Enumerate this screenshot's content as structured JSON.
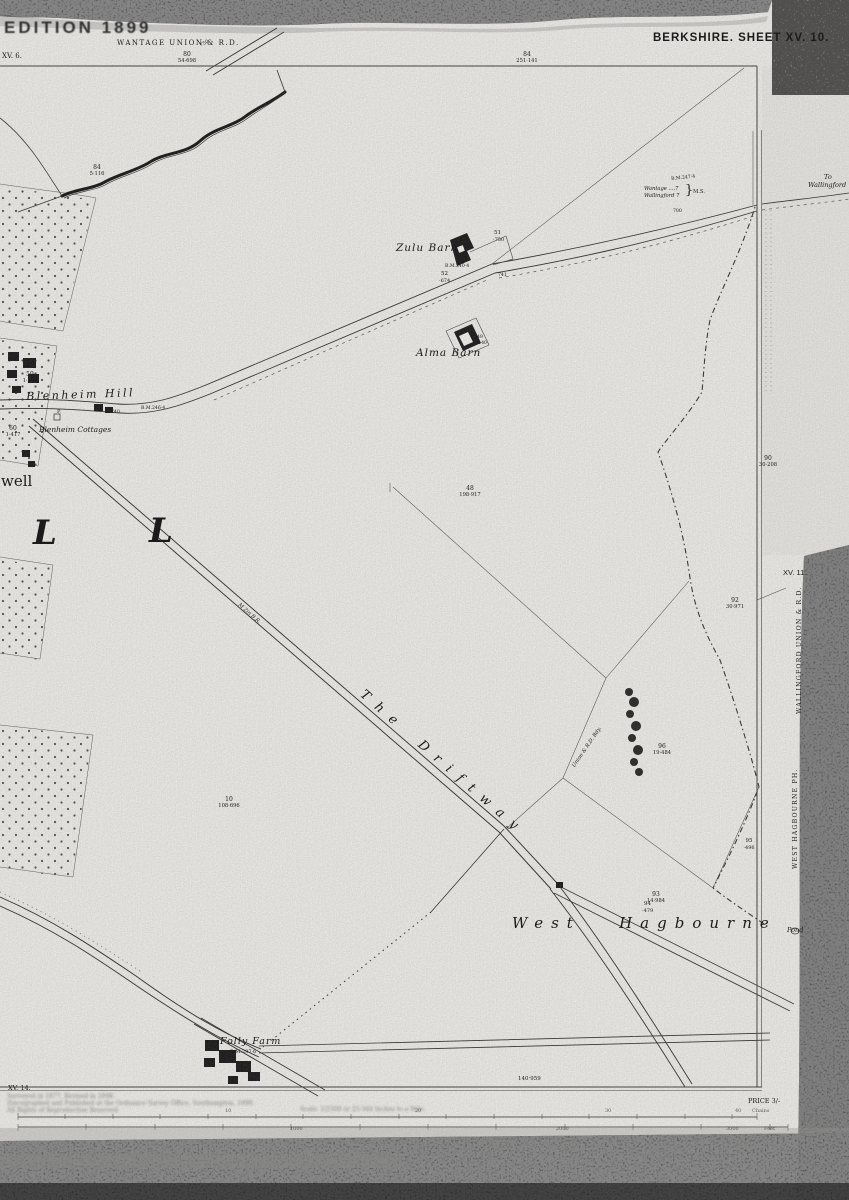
{
  "colors": {
    "paper": "#f2f1ed",
    "ink": "#1b1b1b",
    "scan_band": "#0d0d0d",
    "faint_line": "#4a4a4a"
  },
  "sheet": {
    "edition": "EDITION 1899",
    "title": "BERKSHIRE. SHEET XV. 10."
  },
  "labels": [
    {
      "n": "edition-label",
      "t": "EDITION 1899",
      "x": 4,
      "y": 19,
      "s": 17,
      "ls": 3,
      "c": "sans b deg"
    },
    {
      "n": "wantage-union-label",
      "t": "WANTAGE UNION & R.D.",
      "x": 117,
      "y": 40,
      "s": 7,
      "ls": 1.5
    },
    {
      "n": "adjacent-sheet-xv6",
      "t": "XV. 6.",
      "x": 2,
      "y": 53,
      "s": 7
    },
    {
      "n": "sheet-title",
      "t": "BERKSHIRE. SHEET XV. 10.",
      "x": 653,
      "y": 33,
      "s": 11.5,
      "ls": 1,
      "c": "sans b"
    },
    {
      "n": "parcel-80-number",
      "t": "80",
      "x": 187,
      "y": 52,
      "s": 6,
      "c": "ctr"
    },
    {
      "n": "parcel-80-area",
      "t": "54·698",
      "x": 187,
      "y": 59,
      "s": 5.2,
      "c": "ctr"
    },
    {
      "n": "parcel-84-number",
      "t": "84",
      "x": 527,
      "y": 52,
      "s": 6,
      "c": "ctr"
    },
    {
      "n": "parcel-84-area",
      "t": "251·141",
      "x": 527,
      "y": 59,
      "s": 5.2,
      "c": "ctr"
    },
    {
      "n": "spot-height-750",
      "t": "750",
      "x": 200,
      "y": 45,
      "s": 4.8,
      "r": -30
    },
    {
      "n": "parcel-84w-number",
      "t": "84",
      "x": 97,
      "y": 165,
      "s": 6,
      "c": "ctr"
    },
    {
      "n": "parcel-84w-area",
      "t": "5·116",
      "x": 97,
      "y": 172,
      "s": 5.2,
      "c": "ctr"
    },
    {
      "n": "parcel-59-number",
      "t": "59",
      "x": 30,
      "y": 372,
      "s": 6,
      "c": "ctr"
    },
    {
      "n": "parcel-59-area",
      "t": "1·204",
      "x": 30,
      "y": 379,
      "s": 5.2,
      "c": "ctr"
    },
    {
      "n": "parcel-60-number",
      "t": "60",
      "x": 13,
      "y": 426,
      "s": 6,
      "c": "ctr"
    },
    {
      "n": "parcel-60-area",
      "t": "1·417",
      "x": 13,
      "y": 433,
      "s": 5.2,
      "c": "ctr"
    },
    {
      "n": "zulu-barn-label",
      "t": "Zulu Barn",
      "x": 396,
      "y": 243,
      "s": 10.5,
      "ls": 1,
      "c": "it"
    },
    {
      "n": "parcel-51-number",
      "t": "51",
      "x": 494,
      "y": 231,
      "s": 5.5
    },
    {
      "n": "parcel-51-area",
      "t": "·750",
      "x": 493,
      "y": 238,
      "s": 5
    },
    {
      "n": "bm-240-4",
      "t": "B.M.240·4",
      "x": 445,
      "y": 265,
      "s": 4.6
    },
    {
      "n": "parcel-52-number",
      "t": "52",
      "x": 441,
      "y": 272,
      "s": 5.5
    },
    {
      "n": "parcel-52-area",
      "t": "·674",
      "x": 439,
      "y": 279,
      "s": 5
    },
    {
      "n": "level-741",
      "t": "741",
      "x": 498,
      "y": 274,
      "s": 4.6
    },
    {
      "n": "alma-barn-label",
      "t": "Alma Barn",
      "x": 416,
      "y": 348,
      "s": 10.5,
      "ls": 1,
      "c": "it"
    },
    {
      "n": "parcel-49-number",
      "t": "49",
      "x": 477,
      "y": 336,
      "s": 4.6
    },
    {
      "n": "parcel-49-area",
      "t": "·140",
      "x": 477,
      "y": 342,
      "s": 4.4
    },
    {
      "n": "blenheim-hill-label",
      "t": "Blenheim Hill",
      "x": 26,
      "y": 391,
      "s": 11,
      "ls": 2.5,
      "r": -2,
      "c": "it"
    },
    {
      "n": "level-740",
      "t": "740",
      "x": 111,
      "y": 411,
      "s": 4.6
    },
    {
      "n": "bm-246-4",
      "t": "B.M.246·4",
      "x": 141,
      "y": 407,
      "s": 4.6
    },
    {
      "n": "pump-label",
      "t": "P.",
      "x": 57,
      "y": 410,
      "s": 5
    },
    {
      "n": "blenheim-cottages-label",
      "t": "Blenheim Cottages",
      "x": 39,
      "y": 426,
      "s": 7.5,
      "c": "it"
    },
    {
      "n": "well-name-fragment",
      "t": "well",
      "x": 1,
      "y": 474,
      "s": 15
    },
    {
      "n": "district-letter-l1",
      "t": "L",
      "x": 33,
      "y": 516,
      "s": 34,
      "c": "it b"
    },
    {
      "n": "district-letter-l2",
      "t": "L",
      "x": 149,
      "y": 514,
      "s": 34,
      "c": "it b"
    },
    {
      "n": "parcel-48-number",
      "t": "48",
      "x": 470,
      "y": 486,
      "s": 6,
      "c": "ctr"
    },
    {
      "n": "parcel-48-area",
      "t": "198·917",
      "x": 470,
      "y": 493,
      "s": 5.2,
      "c": "ctr"
    },
    {
      "n": "ms-destination-1",
      "t": "Wantage ....7",
      "x": 644,
      "y": 187,
      "s": 5.2,
      "c": "it"
    },
    {
      "n": "ms-destination-2",
      "t": "Wallingford 7",
      "x": 644,
      "y": 194,
      "s": 5.2,
      "c": "it"
    },
    {
      "n": "ms-brace",
      "t": "}",
      "x": 685,
      "y": 184,
      "s": 13
    },
    {
      "n": "milestone-label",
      "t": "M.S.",
      "x": 693,
      "y": 190,
      "s": 5.2
    },
    {
      "n": "bm-247-4",
      "t": "B.M.247·4",
      "x": 671,
      "y": 178,
      "s": 4.6,
      "r": -6
    },
    {
      "n": "to-wallingford-line1",
      "t": "To",
      "x": 824,
      "y": 174,
      "s": 6.5,
      "c": "it"
    },
    {
      "n": "to-wallingford-line2",
      "t": "Wallingford",
      "x": 808,
      "y": 182,
      "s": 6.5,
      "c": "it"
    },
    {
      "n": "level-700",
      "t": "700",
      "x": 673,
      "y": 210,
      "s": 4.6
    },
    {
      "n": "parcel-90-number",
      "t": "90",
      "x": 768,
      "y": 456,
      "s": 6,
      "c": "ctr"
    },
    {
      "n": "parcel-90-area",
      "t": "30·208",
      "x": 768,
      "y": 463,
      "s": 5.2,
      "c": "ctr"
    },
    {
      "n": "adjacent-sheet-xv11",
      "t": "XV. 11.",
      "x": 783,
      "y": 569,
      "s": 7.5,
      "c": "sans"
    },
    {
      "n": "wallingford-union-vertical",
      "t": "WALLINGFORD UNION & R.D.",
      "x": 797,
      "y": 714,
      "s": 6.2,
      "ls": 1.2,
      "r": -90
    },
    {
      "n": "parcel-92-number",
      "t": "92",
      "x": 735,
      "y": 598,
      "s": 6,
      "c": "ctr"
    },
    {
      "n": "parcel-92-area",
      "t": "30·971",
      "x": 735,
      "y": 605,
      "s": 5.2,
      "c": "ctr"
    },
    {
      "n": "bridle-road-annotation",
      "t": "M 2in B.R.",
      "x": 240,
      "y": 603,
      "s": 5.2,
      "r": 41,
      "c": "it"
    },
    {
      "n": "driftway-label",
      "t": "T h e    D r i f t w a y",
      "x": 366,
      "y": 688,
      "s": 13,
      "ls": 3,
      "r": 41,
      "c": "it"
    },
    {
      "n": "boundary-annotation",
      "t": "Union & R.D. Bdy.",
      "x": 572,
      "y": 766,
      "s": 5.2,
      "r": -56,
      "c": "it"
    },
    {
      "n": "parcel-96-number",
      "t": "96",
      "x": 662,
      "y": 744,
      "s": 6,
      "c": "ctr"
    },
    {
      "n": "parcel-96-area",
      "t": "19·484",
      "x": 662,
      "y": 751,
      "s": 5.2,
      "c": "ctr"
    },
    {
      "n": "parcel-10-number",
      "t": "10",
      "x": 229,
      "y": 797,
      "s": 6,
      "c": "ctr"
    },
    {
      "n": "parcel-10-area",
      "t": "108·696",
      "x": 229,
      "y": 804,
      "s": 5.2,
      "c": "ctr"
    },
    {
      "n": "parcel-95-number",
      "t": "95",
      "x": 749,
      "y": 839,
      "s": 5.5,
      "c": "ctr"
    },
    {
      "n": "parcel-95-area",
      "t": "·496",
      "x": 749,
      "y": 846,
      "s": 5,
      "c": "ctr"
    },
    {
      "n": "west-hagbourne-ph-vertical",
      "t": "WEST HAGBOURNE PH.",
      "x": 793,
      "y": 869,
      "s": 6.2,
      "ls": 1.2,
      "r": -90
    },
    {
      "n": "parcel-93-number",
      "t": "93",
      "x": 656,
      "y": 892,
      "s": 6,
      "c": "ctr"
    },
    {
      "n": "parcel-93-area",
      "t": "14·984",
      "x": 656,
      "y": 899,
      "s": 5.2,
      "c": "ctr"
    },
    {
      "n": "parcel-94-number",
      "t": "94",
      "x": 644,
      "y": 902,
      "s": 5.5
    },
    {
      "n": "parcel-94-area",
      "t": "·479",
      "x": 642,
      "y": 909,
      "s": 5
    },
    {
      "n": "west-hagbourne-name",
      "t": "West   Hagbourne",
      "x": 512,
      "y": 916,
      "s": 15,
      "ls": 8,
      "c": "it"
    },
    {
      "n": "pond-label",
      "t": "Pond",
      "x": 787,
      "y": 927,
      "s": 6.5,
      "c": "it"
    },
    {
      "n": "folly-farm-label",
      "t": "Folly Farm",
      "x": 220,
      "y": 1037,
      "s": 9.5,
      "ls": 1,
      "c": "it"
    },
    {
      "n": "bm-297-6",
      "t": "B.M.297·6",
      "x": 230,
      "y": 1050,
      "s": 5
    },
    {
      "n": "adjacent-sheet-xv14",
      "t": "XV. 14.",
      "x": 8,
      "y": 1085,
      "s": 6.5
    },
    {
      "n": "acreage-total",
      "t": "140·959",
      "x": 518,
      "y": 1077,
      "s": 5.5
    },
    {
      "n": "imprint-line-1",
      "t": "Surveyed in 1877. Revised in 1898.",
      "x": 7,
      "y": 1094,
      "s": 6,
      "c": "blurred"
    },
    {
      "n": "imprint-line-2",
      "t": "Zincographed and Published at the Ordnance Survey Office, Southampton, 1899.",
      "x": 7,
      "y": 1101,
      "s": 6,
      "c": "blurred"
    },
    {
      "n": "imprint-line-3",
      "t": "All Rights of Reproduction Reserved.",
      "x": 7,
      "y": 1108,
      "s": 6,
      "c": "blurred"
    },
    {
      "n": "scale-caption",
      "t": "Scale: 1/2500 or 25·344 Inches to a Mile.",
      "x": 300,
      "y": 1107,
      "s": 6,
      "c": "blurred"
    },
    {
      "n": "price-label",
      "t": "PRICE 3/-",
      "x": 748,
      "y": 1098,
      "s": 6.5
    },
    {
      "n": "scale-chains-10",
      "t": "10",
      "x": 225,
      "y": 1109,
      "s": 5,
      "c": "dim"
    },
    {
      "n": "scale-chains-20",
      "t": "20",
      "x": 415,
      "y": 1109,
      "s": 5,
      "c": "dim"
    },
    {
      "n": "scale-chains-30",
      "t": "30",
      "x": 605,
      "y": 1109,
      "s": 5,
      "c": "dim"
    },
    {
      "n": "scale-chains-40",
      "t": "40",
      "x": 735,
      "y": 1109,
      "s": 5,
      "c": "dim"
    },
    {
      "n": "scale-chains-unit",
      "t": "Chains",
      "x": 752,
      "y": 1109,
      "s": 5,
      "c": "dim"
    },
    {
      "n": "scale-feet-1000",
      "t": "1000",
      "x": 290,
      "y": 1127,
      "s": 5,
      "c": "dim"
    },
    {
      "n": "scale-feet-2000",
      "t": "2000",
      "x": 556,
      "y": 1127,
      "s": 5,
      "c": "dim"
    },
    {
      "n": "scale-feet-3000",
      "t": "3000",
      "x": 726,
      "y": 1127,
      "s": 5,
      "c": "dim"
    },
    {
      "n": "scale-feet-unit",
      "t": "Feet",
      "x": 764,
      "y": 1127,
      "s": 5,
      "c": "dim"
    }
  ]
}
